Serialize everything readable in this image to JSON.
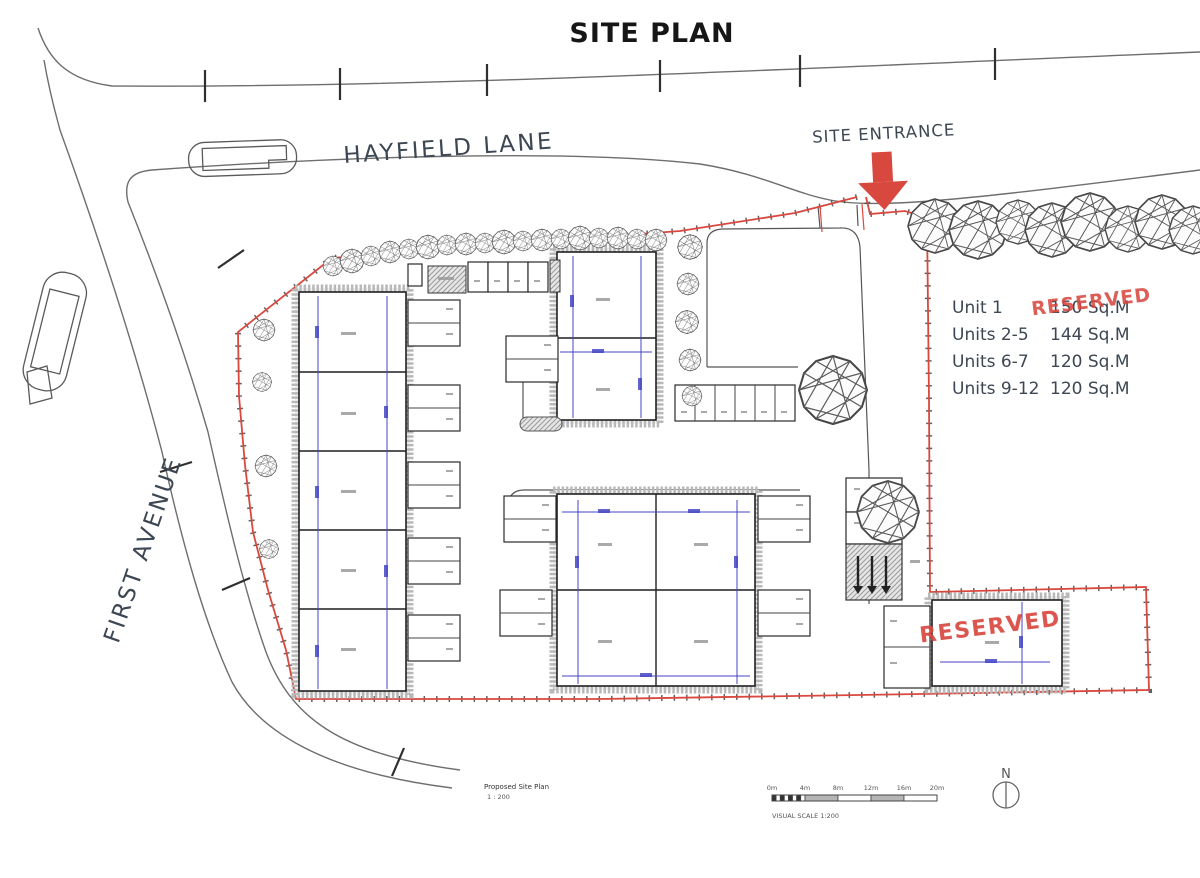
{
  "title": "SITE PLAN",
  "roads": {
    "hayfield_lane": "HAYFIELD LANE",
    "first_avenue": "FIRST AVENUE"
  },
  "entrance": {
    "label": "SITE ENTRANCE"
  },
  "legend": {
    "rows": [
      {
        "label": "Unit 1",
        "value": "150 Sq.M",
        "stamp": "RESERVED"
      },
      {
        "label": "Units 2-5",
        "value": "144 Sq.M"
      },
      {
        "label": "Units 6-7",
        "value": "120 Sq.M"
      },
      {
        "label": "Units 9-12",
        "value": "120 Sq.M"
      }
    ]
  },
  "reserved_unit_stamp": "RESERVED",
  "scalebar": {
    "ticks": [
      "0m",
      "4m",
      "8m",
      "12m",
      "16m",
      "20m"
    ],
    "caption": "VISUAL SCALE 1:200"
  },
  "titleblock": {
    "name": "Proposed Site Plan",
    "scale": "1 : 200"
  },
  "north": {
    "label": "N"
  },
  "colors": {
    "red": "#d9483f",
    "blue": "#4545c4",
    "slate": "#3d4753",
    "ink": "#2e2e2e",
    "wall": "#b8b8b8"
  }
}
